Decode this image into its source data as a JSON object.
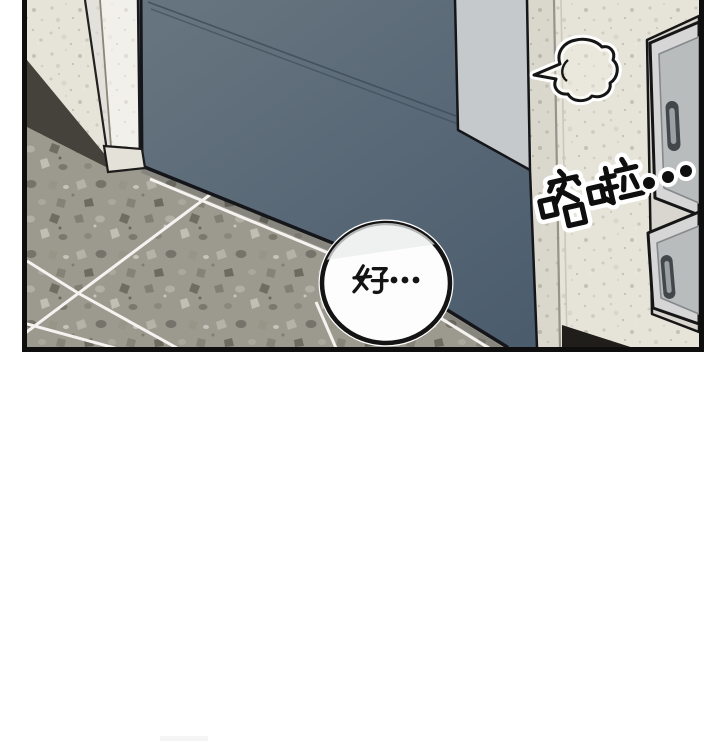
{
  "panel": {
    "sfx_text": "喀啦…",
    "dialogue_text": "好…"
  },
  "colors": {
    "outline": "#111111",
    "wall": "#e6e3d9",
    "wall_speckle": "#cdc9bb",
    "floor": "#9c998f",
    "door_top": "#66747f",
    "door_bottom": "#4b5c6d",
    "door_edge_panel": "#c6c9cc",
    "cabinet_frame": "#d5d6d5",
    "drawer_inner": "#b9bcbd",
    "handle_slot": "#42474b",
    "handle_inner": "#9aa0a3",
    "baseboard": "#45423c",
    "grout_line": "#f4f3ef",
    "bubble_fill": "#fdfdfd",
    "bubble_shade": "#e9ebeb",
    "shadow_dark": "#201e1a",
    "background": "#ffffff"
  }
}
